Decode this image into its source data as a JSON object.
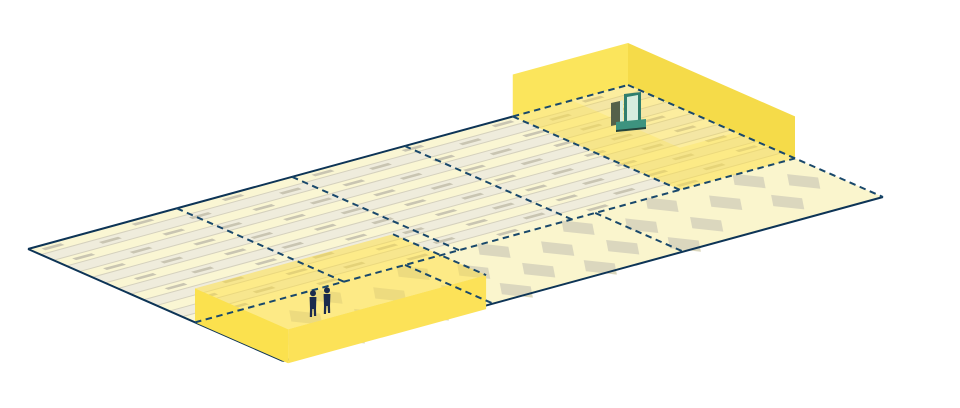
{
  "diagram": {
    "type": "isometric-floor-plan",
    "description": "Isometric warehouse floor plate divided by dashed navy gridlines into bays; striped slab zone and plain apron zone; two highlighted translucent yellow volumes, one containing a forklift, one with two workers standing on a low platform.",
    "zones": [
      {
        "id": "forklift-bay",
        "occupant": "forklift",
        "position": "top-right",
        "style": "tall-open-walls"
      },
      {
        "id": "workers-bay",
        "occupant": "two-workers",
        "position": "bottom-left",
        "style": "low-platform"
      }
    ]
  },
  "colors": {
    "background": "#ffffff",
    "edge_solid": "#0d3456",
    "edge_dashed": "#19486b",
    "stripe_a": "#faf6d3",
    "stripe_b": "#efecdc",
    "stripe_separator": "#d5d1be",
    "stripe_marker": "#c9c5b2",
    "plain_floor": "#faf5cd",
    "diamond_marker": "#dbd7be",
    "zone_interior_tint": "rgba(255,222,60,0.35)",
    "zone_front_wall": "rgba(252,228,85,0.32)",
    "zone_wall_left": "#fbe55c",
    "zone_wall_right": "#f5db49",
    "platform_top": "rgba(255,223,64,0.5)",
    "platform_front_left": "#fbe14e",
    "platform_front_right": "#fce258",
    "worker": "#1b2b4d",
    "forklift_mast": "#2f7e6e",
    "forklift_mast_inner": "#d7eddf",
    "forklift_carriage": "#55614a",
    "forklift_base": "#3d937f",
    "forklift_dark": "#24443c"
  },
  "iso": {
    "origin": [
      28,
      249
    ],
    "axis_a": [
      600,
      -164
    ],
    "axis_b": [
      255,
      112
    ]
  },
  "floor": {
    "stripe_count": 13,
    "stripe_region_depth": 0.655,
    "striped_dividers_a": [
      0.248,
      0.44,
      0.628,
      0.808
    ],
    "plain_dividers_a": [
      0.35,
      0.667
    ],
    "marker_step_a": 0.15,
    "marker_len_a": 0.032,
    "marker_half_b": 0.0075,
    "diamond_rows": [
      {
        "b": 0.71,
        "a": [
          0.055,
          0.195,
          0.34,
          0.475,
          0.615,
          0.755,
          0.9
        ]
      },
      {
        "b": 0.795,
        "a": [
          0.125,
          0.265,
          0.405,
          0.545,
          0.685,
          0.825,
          0.955
        ]
      },
      {
        "b": 0.885,
        "a": [
          0.055,
          0.195,
          0.34,
          0.475,
          0.615,
          0.755,
          0.89
        ]
      },
      {
        "b": 0.962,
        "a": [
          0.125,
          0.265,
          0.405,
          0.545,
          0.685
        ]
      }
    ],
    "diamond_half_a": 0.024,
    "diamond_half_b": 0.065
  },
  "volumes": {
    "forklift_bay": {
      "a0": 0.808,
      "a1": 1.0,
      "b0": 0.0,
      "b1": 0.655,
      "height": 42
    },
    "workers_bay": {
      "a0": 0.0,
      "a1": 0.33,
      "b0": 0.655,
      "b1": 1.02,
      "height": 34
    }
  },
  "figures": {
    "workers": [
      {
        "foot_x": 313,
        "foot_y": 317,
        "h": 27
      },
      {
        "foot_x": 327,
        "foot_y": 314,
        "h": 27
      }
    ],
    "forklift": {
      "x": 611,
      "foot_y": 131
    }
  }
}
